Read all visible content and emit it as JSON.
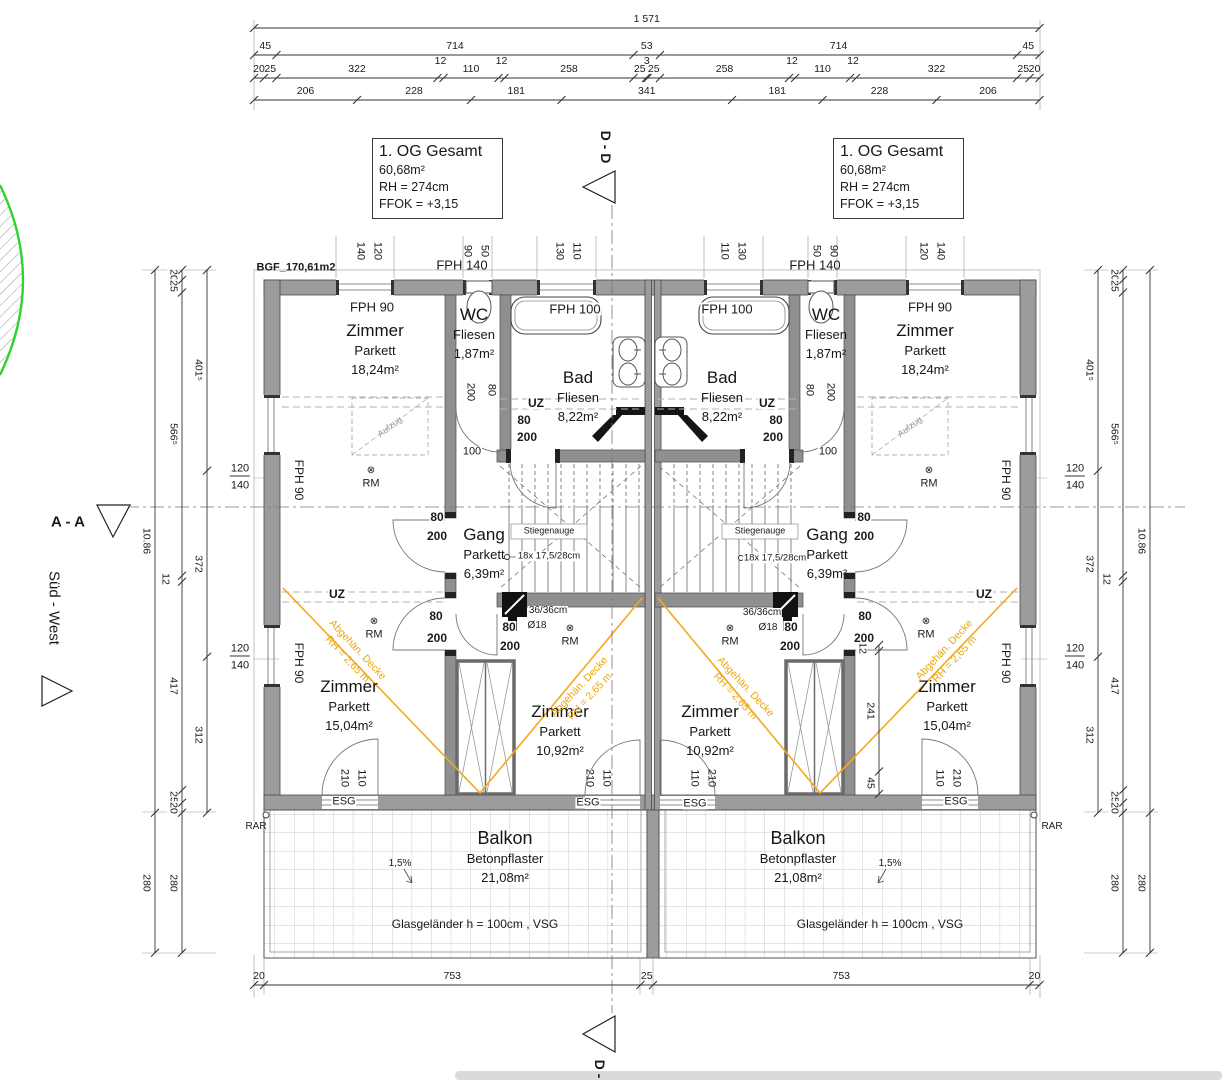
{
  "title_blocks": {
    "left": {
      "title": "1. OG Gesamt",
      "area": "60,68m²",
      "rh": "RH = 274cm",
      "ffok": "FFOK = +3,15"
    },
    "right": {
      "title": "1. OG Gesamt",
      "area": "60,68m²",
      "rh": "RH = 274cm",
      "ffok": "FFOK = +3,15"
    }
  },
  "colors": {
    "wall_gray": "#9c9c9c",
    "orange": "#f0a400",
    "green": "#2fd32f",
    "tile_line": "#b8b8b8",
    "bottom_bar": "#dadada"
  },
  "dim_chains": {
    "horizontal": [
      {
        "name": "top-total",
        "x0": 254,
        "y": 28,
        "scale": 0.5,
        "values": [
          1571
        ],
        "labels": [
          "1 571"
        ]
      },
      {
        "name": "top-main",
        "x0": 254,
        "y": 55,
        "scale": 0.5,
        "values": [
          45,
          714,
          53,
          714,
          45
        ],
        "labels": [
          "45",
          "714",
          "53",
          "714",
          "45"
        ]
      },
      {
        "name": "top-detail",
        "x0": 254,
        "y": 78,
        "scale": 0.5,
        "values": [
          20,
          25,
          322,
          12,
          110,
          12,
          258,
          25,
          3,
          25,
          258,
          12,
          110,
          12,
          322,
          25,
          20
        ],
        "labels": [
          "20",
          "25",
          "322",
          "12",
          "110",
          "12",
          "258",
          "25",
          "3",
          "25",
          "258",
          "12",
          "110",
          "12",
          "322",
          "25",
          "20"
        ]
      },
      {
        "name": "top-sub",
        "x0": 254,
        "y": 100,
        "scale": 0.5,
        "values": [
          206,
          228,
          181,
          341,
          181,
          228,
          206
        ],
        "labels": [
          "206",
          "228",
          "181",
          "341",
          "181",
          "228",
          "206"
        ]
      },
      {
        "name": "bottom",
        "x0": 254,
        "y": 985,
        "scale": 0.5,
        "values": [
          20,
          753,
          25,
          753,
          20
        ],
        "labels": [
          "20",
          "753",
          "25",
          "753",
          "20"
        ]
      }
    ],
    "vertical": [
      {
        "name": "left-inner",
        "x": 207,
        "y0": 270,
        "scale": 0.5,
        "values": [
          401.5,
          372,
          312
        ],
        "labels": [
          "401⁵",
          "372",
          "312"
        ]
      },
      {
        "name": "left-mid",
        "x": 182,
        "y0": 270,
        "scale": 0.5,
        "values": [
          20,
          25,
          566.5,
          12,
          417,
          25,
          20,
          280
        ],
        "labels": [
          "20",
          "25",
          "566⁵",
          "12",
          "417",
          "25",
          "20",
          "280"
        ]
      },
      {
        "name": "left-outer",
        "x": 155,
        "y0": 270,
        "scale": 0.5,
        "values": [
          1085.5,
          280
        ],
        "labels": [
          "10.86",
          "280"
        ]
      },
      {
        "name": "right-inner",
        "x": 1098,
        "y0": 270,
        "scale": 0.5,
        "values": [
          401.5,
          372,
          312
        ],
        "labels": [
          "401⁵",
          "372",
          "312"
        ]
      },
      {
        "name": "right-mid",
        "x": 1123,
        "y0": 270,
        "scale": 0.5,
        "values": [
          20,
          25,
          566.5,
          12,
          417,
          25,
          20,
          280
        ],
        "labels": [
          "20",
          "25",
          "566⁵",
          "12",
          "417",
          "25",
          "20",
          "280"
        ]
      },
      {
        "name": "right-outer",
        "x": 1150,
        "y0": 270,
        "scale": 0.5,
        "values": [
          1085.5,
          280
        ],
        "labels": [
          "10.86",
          "280"
        ]
      },
      {
        "name": "shaft-right",
        "x": 879,
        "y0": 645,
        "scale": 0.5,
        "values": [
          12,
          241,
          45
        ],
        "labels": [
          "12",
          "241",
          "45"
        ]
      }
    ]
  },
  "rooms": [
    {
      "lines": [
        "Zimmer",
        "Parkett",
        "18,24m²"
      ],
      "x": 375,
      "y": 331
    },
    {
      "lines": [
        "Zimmer",
        "Parkett",
        "18,24m²"
      ],
      "x": 925,
      "y": 331
    },
    {
      "lines": [
        "WC",
        "Fliesen",
        "1,87m²"
      ],
      "x": 474,
      "y": 315
    },
    {
      "lines": [
        "WC",
        "Fliesen",
        "1,87m²"
      ],
      "x": 826,
      "y": 315
    },
    {
      "lines": [
        "Bad",
        "Fliesen",
        "8,22m²"
      ],
      "x": 578,
      "y": 378
    },
    {
      "lines": [
        "Bad",
        "Fliesen",
        "8,22m²"
      ],
      "x": 722,
      "y": 378
    },
    {
      "lines": [
        "Gang",
        "Parkett",
        "6,39m²"
      ],
      "x": 484,
      "y": 535
    },
    {
      "lines": [
        "Gang",
        "Parkett",
        "6,39m²"
      ],
      "x": 827,
      "y": 535
    },
    {
      "lines": [
        "Zimmer",
        "Parkett",
        "15,04m²"
      ],
      "x": 349,
      "y": 687
    },
    {
      "lines": [
        "Zimmer",
        "Parkett",
        "15,04m²"
      ],
      "x": 947,
      "y": 687
    },
    {
      "lines": [
        "Zimmer",
        "Parkett",
        "10,92m²"
      ],
      "x": 560,
      "y": 712
    },
    {
      "lines": [
        "Zimmer",
        "Parkett",
        "10,92m²"
      ],
      "x": 710,
      "y": 712
    },
    {
      "lines": [
        "Balkon",
        "Betonpflaster",
        "21,08m²"
      ],
      "x": 505,
      "y": 839,
      "big": 1
    },
    {
      "lines": [
        "Balkon",
        "Betonpflaster",
        "21,08m²"
      ],
      "x": 798,
      "y": 839,
      "big": 1
    }
  ],
  "ceiling_notes": [
    {
      "text": "Abgehän. Decke\nRH = 2,65 m",
      "x": 352,
      "y": 655,
      "rot": 47
    },
    {
      "text": "Abgehän. Decke\nRH = 2,65 m",
      "x": 585,
      "y": 692,
      "rot": -47
    },
    {
      "text": "Abgehän. Decke\nRH = 2,65 m",
      "x": 740,
      "y": 692,
      "rot": 47
    },
    {
      "text": "Abgehän. Decke\nRH = 2,65 m",
      "x": 950,
      "y": 655,
      "rot": -47
    }
  ],
  "labels": [
    {
      "t": "BGF_170,61m2",
      "x": 296,
      "y": 268,
      "s": 11,
      "b": 1
    },
    {
      "t": "D - D",
      "x": 606,
      "y": 147,
      "s": 14,
      "b": 1,
      "r": 90
    },
    {
      "t": "D - D",
      "x": 600,
      "y": 1076,
      "s": 14,
      "b": 1,
      "r": 90
    },
    {
      "t": "A - A",
      "x": 68,
      "y": 522,
      "s": 15,
      "b": 1
    },
    {
      "t": "Süd - West",
      "x": 54,
      "y": 608,
      "s": 15,
      "r": 90
    },
    {
      "t": "RAR",
      "x": 256,
      "y": 827,
      "s": 10
    },
    {
      "t": "RAR",
      "x": 1052,
      "y": 827,
      "s": 10
    },
    {
      "t": "140",
      "x": 360,
      "y": 251,
      "s": 11,
      "r": 90
    },
    {
      "t": "120",
      "x": 377,
      "y": 251,
      "s": 11,
      "r": 90
    },
    {
      "t": "90",
      "x": 467,
      "y": 251,
      "s": 11,
      "r": 90
    },
    {
      "t": "50",
      "x": 484,
      "y": 251,
      "s": 11,
      "r": 90
    },
    {
      "t": "130",
      "x": 559,
      "y": 251,
      "s": 11,
      "r": 90
    },
    {
      "t": "110",
      "x": 576,
      "y": 251,
      "s": 11,
      "r": 90
    },
    {
      "t": "110",
      "x": 724,
      "y": 251,
      "s": 11,
      "r": 90
    },
    {
      "t": "130",
      "x": 741,
      "y": 251,
      "s": 11,
      "r": 90
    },
    {
      "t": "50",
      "x": 816,
      "y": 251,
      "s": 11,
      "r": 90
    },
    {
      "t": "90",
      "x": 833,
      "y": 251,
      "s": 11,
      "r": 90
    },
    {
      "t": "120",
      "x": 923,
      "y": 251,
      "s": 11,
      "r": 90
    },
    {
      "t": "140",
      "x": 940,
      "y": 251,
      "s": 11,
      "r": 90
    },
    {
      "t": "FPH 140",
      "x": 462,
      "y": 265,
      "s": 13
    },
    {
      "t": "FPH 140",
      "x": 815,
      "y": 265,
      "s": 13
    },
    {
      "t": "FPH 90",
      "x": 372,
      "y": 307,
      "s": 13
    },
    {
      "t": "FPH 90",
      "x": 930,
      "y": 307,
      "s": 13
    },
    {
      "t": "FPH 100",
      "x": 575,
      "y": 309,
      "s": 13,
      "bg": 1
    },
    {
      "t": "FPH 100",
      "x": 727,
      "y": 309,
      "s": 13,
      "bg": 1
    },
    {
      "t": "FPH 90",
      "x": 299,
      "y": 480,
      "s": 12,
      "r": 90
    },
    {
      "t": "FPH 90",
      "x": 299,
      "y": 663,
      "s": 12,
      "r": 90
    },
    {
      "t": "FPH 90",
      "x": 1006,
      "y": 480,
      "s": 12,
      "r": 90
    },
    {
      "t": "FPH 90",
      "x": 1006,
      "y": 663,
      "s": 12,
      "r": 90
    },
    {
      "t": "120",
      "x": 240,
      "y": 470,
      "s": 11,
      "u": 1,
      "bg": 1
    },
    {
      "t": "140",
      "x": 240,
      "y": 486,
      "s": 11,
      "bg": 1
    },
    {
      "t": "120",
      "x": 240,
      "y": 650,
      "s": 11,
      "u": 1,
      "bg": 1
    },
    {
      "t": "140",
      "x": 240,
      "y": 666,
      "s": 11,
      "bg": 1
    },
    {
      "t": "120",
      "x": 1075,
      "y": 470,
      "s": 11,
      "u": 1,
      "bg": 1
    },
    {
      "t": "140",
      "x": 1075,
      "y": 486,
      "s": 11,
      "bg": 1
    },
    {
      "t": "120",
      "x": 1075,
      "y": 650,
      "s": 11,
      "u": 1,
      "bg": 1
    },
    {
      "t": "140",
      "x": 1075,
      "y": 666,
      "s": 11,
      "bg": 1
    },
    {
      "t": "Glasgeländer h = 100cm , VSG",
      "x": 475,
      "y": 924,
      "s": 12
    },
    {
      "t": "Glasgeländer h = 100cm , VSG",
      "x": 880,
      "y": 924,
      "s": 12
    },
    {
      "t": "1,5%",
      "x": 400,
      "y": 864,
      "s": 10
    },
    {
      "t": "1,5%",
      "x": 890,
      "y": 864,
      "s": 10
    },
    {
      "t": "UZ",
      "x": 337,
      "y": 594,
      "s": 12,
      "b": 1,
      "bg": 1
    },
    {
      "t": "UZ",
      "x": 536,
      "y": 403,
      "s": 12,
      "b": 1,
      "bg": 1
    },
    {
      "t": "UZ",
      "x": 767,
      "y": 403,
      "s": 12,
      "b": 1,
      "bg": 1
    },
    {
      "t": "UZ",
      "x": 984,
      "y": 594,
      "s": 12,
      "b": 1,
      "bg": 1
    },
    {
      "t": "⊗",
      "x": 371,
      "y": 471,
      "s": 10
    },
    {
      "t": "RM",
      "x": 371,
      "y": 484,
      "s": 11
    },
    {
      "t": "⊗",
      "x": 929,
      "y": 471,
      "s": 10
    },
    {
      "t": "RM",
      "x": 929,
      "y": 484,
      "s": 11
    },
    {
      "t": "⊗",
      "x": 374,
      "y": 622,
      "s": 10
    },
    {
      "t": "RM",
      "x": 374,
      "y": 635,
      "s": 11
    },
    {
      "t": "⊗",
      "x": 926,
      "y": 622,
      "s": 10
    },
    {
      "t": "RM",
      "x": 926,
      "y": 635,
      "s": 11
    },
    {
      "t": "⊗",
      "x": 570,
      "y": 629,
      "s": 10
    },
    {
      "t": "RM",
      "x": 570,
      "y": 642,
      "s": 11
    },
    {
      "t": "⊗",
      "x": 730,
      "y": 629,
      "s": 10
    },
    {
      "t": "RM",
      "x": 730,
      "y": 642,
      "s": 11
    },
    {
      "t": "ESG",
      "x": 344,
      "y": 802,
      "s": 11,
      "bg": 1
    },
    {
      "t": "ESG",
      "x": 588,
      "y": 803,
      "s": 11,
      "bg": 1
    },
    {
      "t": "ESG",
      "x": 695,
      "y": 804,
      "s": 11,
      "bg": 1
    },
    {
      "t": "ESG",
      "x": 956,
      "y": 802,
      "s": 11,
      "bg": 1
    },
    {
      "t": "210",
      "x": 344,
      "y": 778,
      "s": 11,
      "r": 90
    },
    {
      "t": "110",
      "x": 361,
      "y": 778,
      "s": 11,
      "r": 90
    },
    {
      "t": "210",
      "x": 589,
      "y": 778,
      "s": 11,
      "r": 90
    },
    {
      "t": "110",
      "x": 606,
      "y": 778,
      "s": 11,
      "r": 90
    },
    {
      "t": "110",
      "x": 694,
      "y": 778,
      "s": 11,
      "r": 90
    },
    {
      "t": "210",
      "x": 711,
      "y": 778,
      "s": 11,
      "r": 90
    },
    {
      "t": "110",
      "x": 939,
      "y": 778,
      "s": 11,
      "r": 90
    },
    {
      "t": "210",
      "x": 956,
      "y": 778,
      "s": 11,
      "r": 90
    },
    {
      "t": "80",
      "x": 437,
      "y": 517,
      "s": 12,
      "b": 1,
      "bg": 1
    },
    {
      "t": "200",
      "x": 437,
      "y": 536,
      "s": 12,
      "b": 1,
      "bg": 1
    },
    {
      "t": "80",
      "x": 436,
      "y": 616,
      "s": 12,
      "b": 1,
      "bg": 1
    },
    {
      "t": "200",
      "x": 437,
      "y": 638,
      "s": 12,
      "b": 1,
      "bg": 1
    },
    {
      "t": "80",
      "x": 509,
      "y": 627,
      "s": 12,
      "b": 1,
      "bg": 1
    },
    {
      "t": "200",
      "x": 510,
      "y": 646,
      "s": 12,
      "b": 1,
      "bg": 1
    },
    {
      "t": "80",
      "x": 524,
      "y": 420,
      "s": 12,
      "b": 1,
      "bg": 1
    },
    {
      "t": "200",
      "x": 527,
      "y": 437,
      "s": 12,
      "b": 1,
      "bg": 1
    },
    {
      "t": "80",
      "x": 864,
      "y": 517,
      "s": 12,
      "b": 1,
      "bg": 1
    },
    {
      "t": "200",
      "x": 864,
      "y": 536,
      "s": 12,
      "b": 1,
      "bg": 1
    },
    {
      "t": "80",
      "x": 865,
      "y": 616,
      "s": 12,
      "b": 1,
      "bg": 1
    },
    {
      "t": "200",
      "x": 864,
      "y": 638,
      "s": 12,
      "b": 1,
      "bg": 1
    },
    {
      "t": "80",
      "x": 791,
      "y": 627,
      "s": 12,
      "b": 1,
      "bg": 1
    },
    {
      "t": "200",
      "x": 790,
      "y": 646,
      "s": 12,
      "b": 1,
      "bg": 1
    },
    {
      "t": "80",
      "x": 776,
      "y": 420,
      "s": 12,
      "b": 1,
      "bg": 1
    },
    {
      "t": "200",
      "x": 773,
      "y": 437,
      "s": 12,
      "b": 1,
      "bg": 1
    },
    {
      "t": "200",
      "x": 470,
      "y": 392,
      "s": 11,
      "r": 90,
      "bg": 1
    },
    {
      "t": "80",
      "x": 491,
      "y": 390,
      "s": 11,
      "r": 90,
      "bg": 1
    },
    {
      "t": "200",
      "x": 830,
      "y": 392,
      "s": 11,
      "r": 90,
      "bg": 1
    },
    {
      "t": "80",
      "x": 809,
      "y": 390,
      "s": 11,
      "r": 90,
      "bg": 1
    },
    {
      "t": "100",
      "x": 472,
      "y": 452,
      "s": 11,
      "bg": 1
    },
    {
      "t": "100",
      "x": 828,
      "y": 452,
      "s": 11,
      "bg": 1
    },
    {
      "t": "Stiegenauge",
      "x": 549,
      "y": 531,
      "s": 9
    },
    {
      "t": "Stiegenauge",
      "x": 760,
      "y": 531,
      "s": 9
    },
    {
      "t": "18x 17,5/28cm",
      "x": 549,
      "y": 556,
      "s": 9.5,
      "bg": 1
    },
    {
      "t": "18x 17,5/28cm",
      "x": 775,
      "y": 558,
      "s": 9.5,
      "bg": 1
    },
    {
      "t": "36/36cm",
      "x": 548,
      "y": 611,
      "s": 10,
      "bg": 1
    },
    {
      "t": "36/36cm",
      "x": 762,
      "y": 613,
      "s": 10,
      "bg": 1
    },
    {
      "t": "Ø18",
      "x": 537,
      "y": 626,
      "s": 10,
      "bg": 1
    },
    {
      "t": "Ø18",
      "x": 768,
      "y": 628,
      "s": 10,
      "bg": 1
    },
    {
      "t": "Aufzug",
      "x": 390,
      "y": 427,
      "s": 9,
      "r": -37,
      "c": "#9a9a9a"
    },
    {
      "t": "Aufzug",
      "x": 910,
      "y": 427,
      "s": 9,
      "r": -37,
      "c": "#9a9a9a"
    }
  ]
}
